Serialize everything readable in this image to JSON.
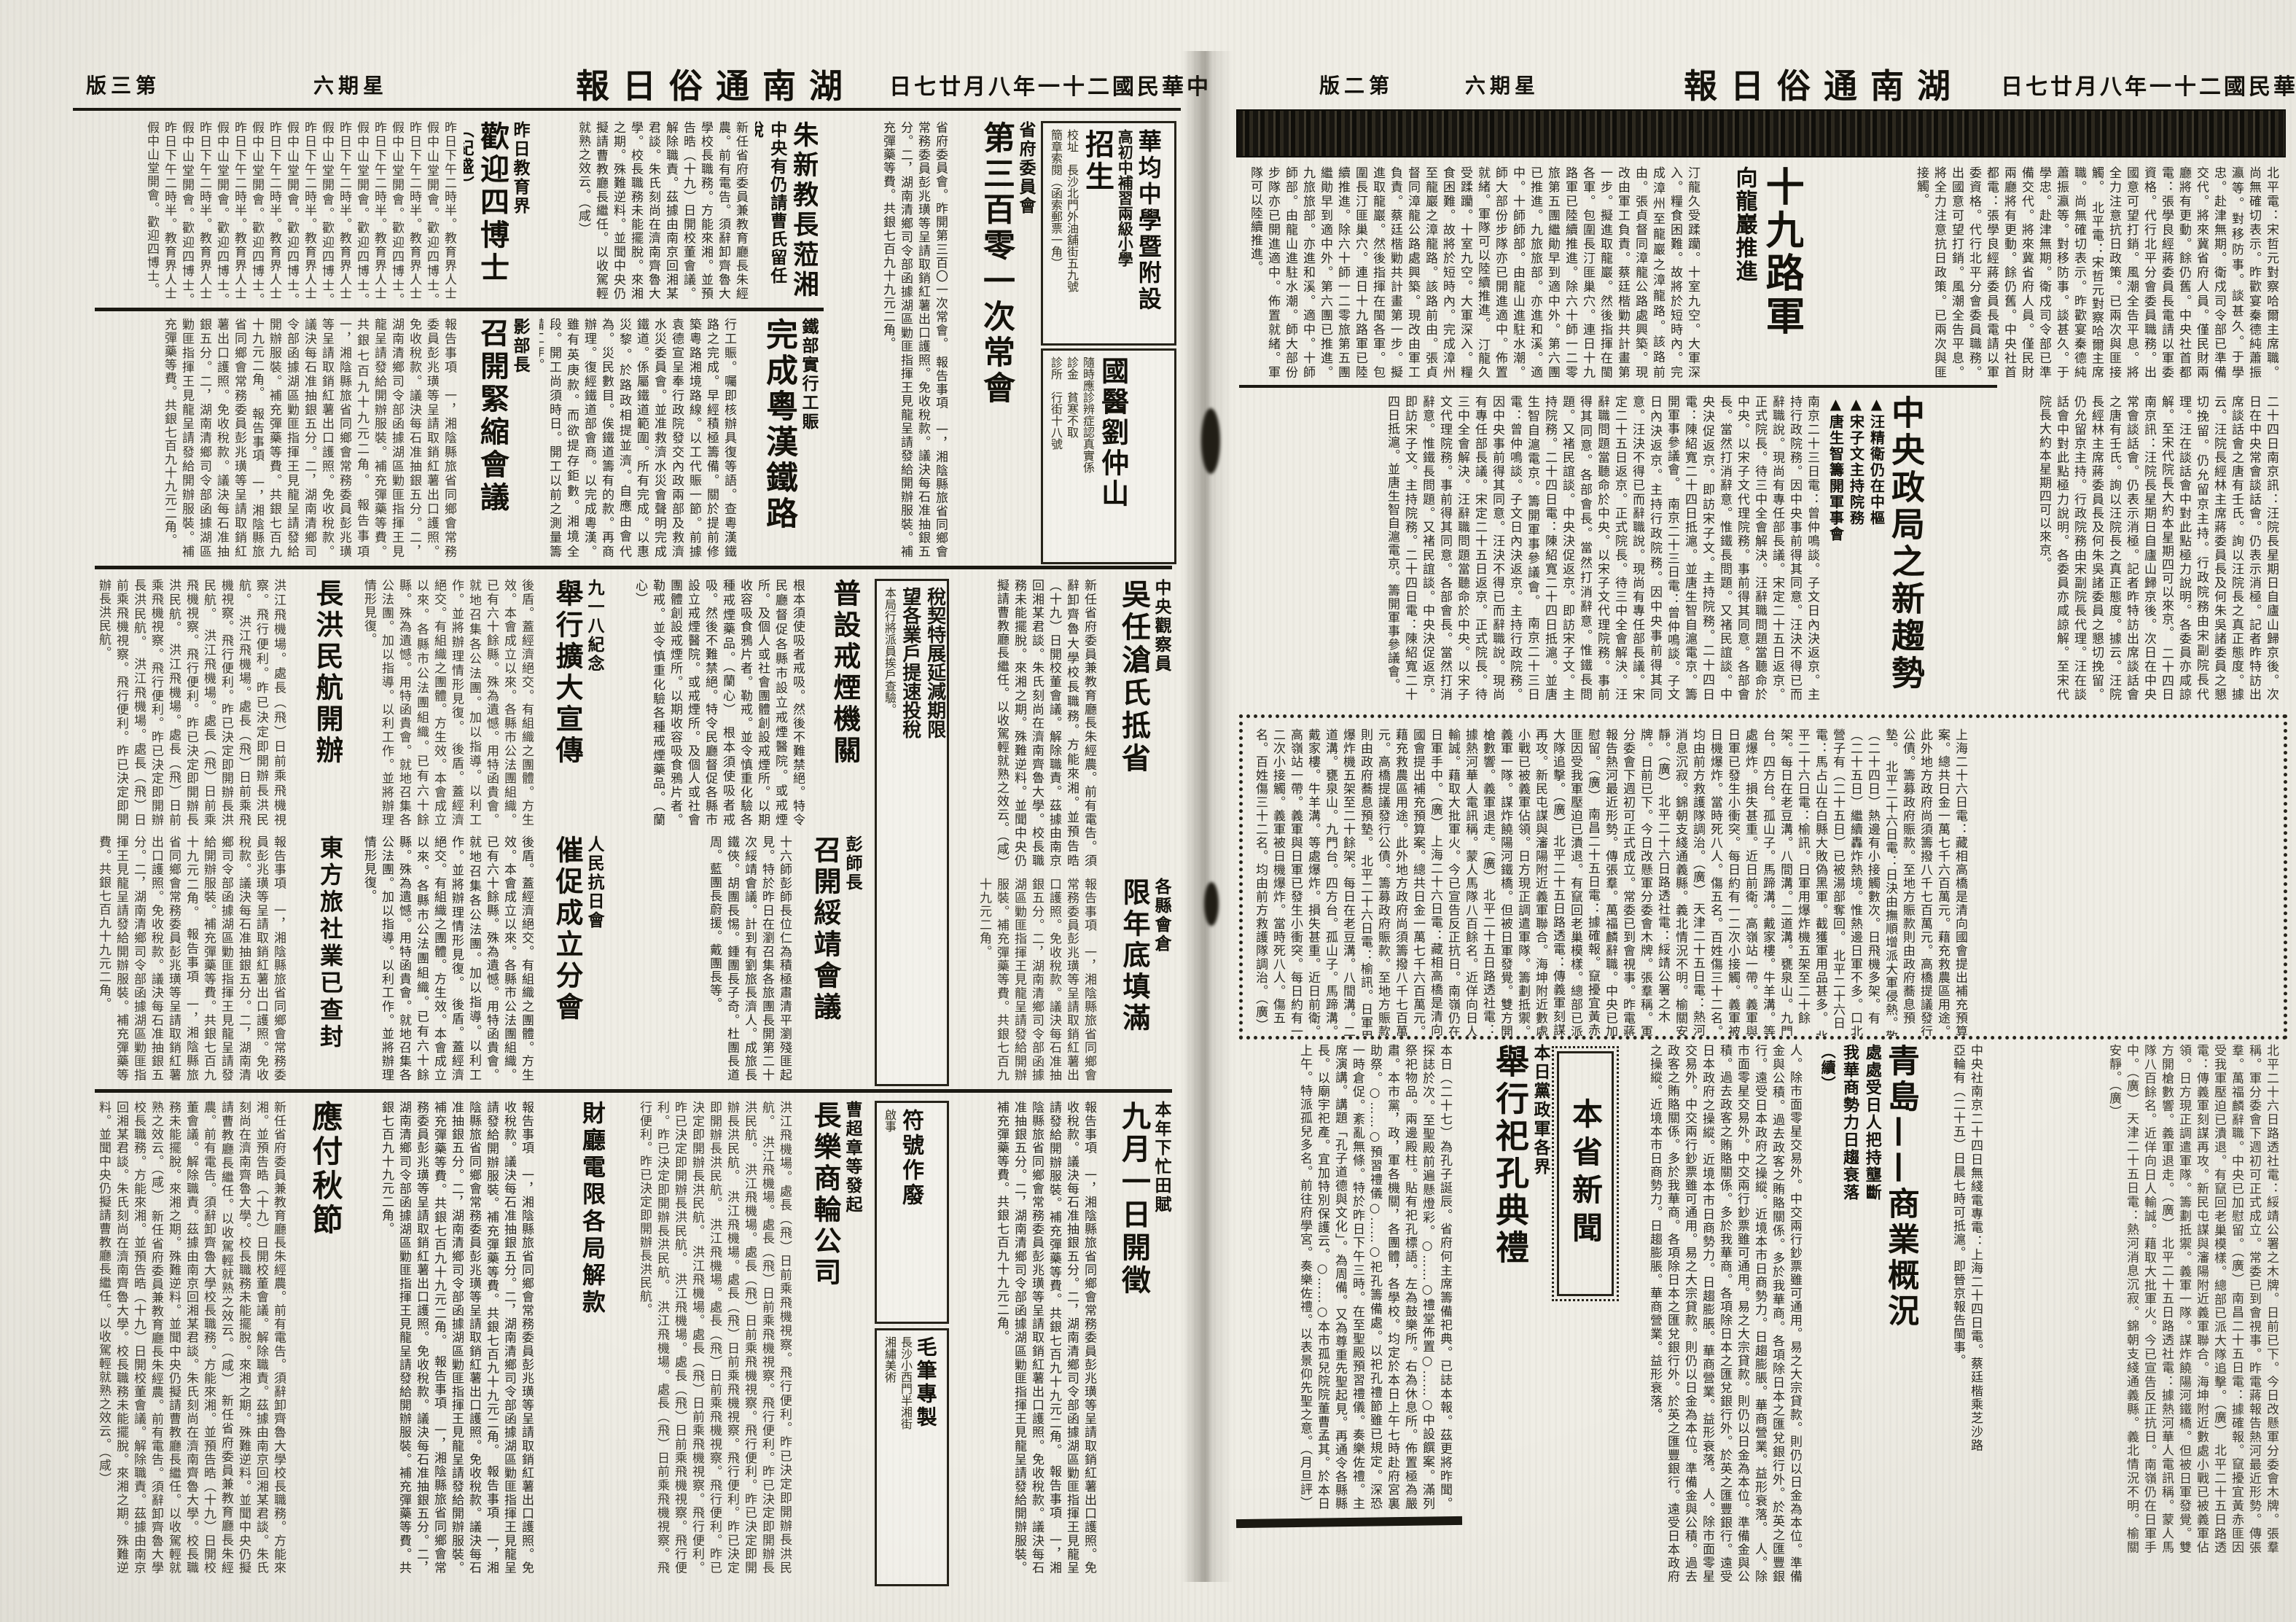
{
  "paper": {
    "name": "湖南通俗日報",
    "date": "中華民國二十一年八月廿七日",
    "weekday": "星期六"
  },
  "page_left": {
    "edition": "第三版",
    "ads": {
      "school": {
        "title": "華均中學暨附設",
        "line2": "高初中補習兩級小學",
        "enroll": "招生",
        "addr": "校址　長沙北門外油舖街五九號",
        "note": "簡章索閱（函索郵票一角）"
      },
      "doctor": {
        "title": "國醫劉仲山",
        "line1": "隨時應診辨症認真實係",
        "line2": "診金　貧寒不取",
        "line3": "診所　行街十八號"
      },
      "tax": {
        "org": "長沙省會稅務徵收局通告",
        "big1": "稅契特展延減期限",
        "big2": "望各業戶提速投稅",
        "note": "本局行將派員挨戶查驗。"
      },
      "fuhao": {
        "title": "符號作廢",
        "note": "啟事"
      },
      "brush": {
        "title": "毛筆專製",
        "line1": "長沙小西門半湘街",
        "line2": "湘繡美術"
      }
    },
    "articles": {
      "provincial": {
        "kicker": "省府委員會",
        "headline": "第三百零一次常會",
        "lead": "省府委員會。昨開第三百〇一次常會。",
        "body": "報告事項　一，湘陰縣旅省同鄉會常務委員彭兆璜等呈請取銷紅薯出口護照。免收稅款。議決每石准抽銀五分。二，湖南清鄉司令部函據湖區勦匪指揮王見龍呈請發給開辦服裝。補充彈藥等費。共銀七百九十九元二角。"
      },
      "zhu": {
        "headline": "朱新教長蒞湘",
        "sub": "中央有仍請曹氏留任說",
        "body": "新任省府委員兼教育廳長朱經農。前有電告。須辭卸齊魯大學校長職務。方能來湘。並預告晧（十九）日開校董會議。解除職責。茲據由南京回湘某君談。朱氏刻尚在濟南齊魯大學。校長職務未能擺脫。來湘之期。殊難逆料。並聞中央仍擬請曹教廳長繼任。以收駕輕就熟之效云。（咸）"
      },
      "welcome": {
        "kicker": "昨日教育界",
        "headline": "歡迎四博士",
        "sub": "（紀盛）",
        "body": "昨日下午二時半。教育界人士假中山堂開會。歡迎四博士。"
      },
      "railway": {
        "kicker": "鐵部實行工賑",
        "headline": "完成粵漢鐵路",
        "body": "行工賑。囑即核辦具復等語。查粵漢鐵路之完成。早經積極籌備。關於提前修築粵路湘境路線。以工代賑一節。前據袁德宣呈奉行政院發交內政兩部及救濟水災委員會。並准救濟水災會聲明完成鐵道。係屬鐵道範圍。所有完成。以惠災黎。於路政相提並濟。自應由會代為。災民數目。俟鐵道籌有的款。再商辦理。復經鐵道部會商。以完成粵漢。雖有英庚款。而欲提存鉅數。湘境全段。開工尚須時日。開工以前之測量籌備工作。"
      },
      "jinsuo": {
        "kicker": "影部長",
        "headline": "召開緊縮會議"
      },
      "wu": {
        "kicker": "中央觀察員",
        "headline": "吳任滄氏抵省"
      },
      "granary": {
        "kicker": "各縣會倉",
        "headline": "限年底填滿"
      },
      "opium": {
        "headline": "普設戒煙機關",
        "body": "根本須使吸者戒吸。然後不難禁絕。特令民廳督促各縣市設立戒煙醫院。或戒煙所。及個人或社會團體創設戒煙所。以期收容吸食鴉片者。勒戒。並令慎重化驗各種戒煙藥品。（蘭心）"
      },
      "peng": {
        "kicker": "彭師長",
        "headline": "召開綏靖會議",
        "body": "十六師彭師長位仁為積極肅清平瀏殘匪起見。特於昨日在瀏召集各旅團長開第二十次綏靖會議。計到有劉旅長濟人。成旅長鐵俠。胡團長惕。鍾團長子奇。杜團長道周。藍團長蔚援。戴團長等。"
      },
      "sep18": {
        "kicker": "九一八紀念",
        "headline": "舉行擴大宣傳"
      },
      "cuicu": {
        "kicker": "人民抗日會",
        "headline": "催促成立分會",
        "body": "後盾。蓋經濟絕交。有組織之團體。方生效。本會成立以來。各縣市公法團組織。已有六十餘縣。殊為遺憾。用特函貴會。就地召集各公法團。加以指導。以利工作。並將辦理情形見復。"
      },
      "changhong": {
        "headline": "長洪民航開辦",
        "body": "洪江飛機場。處長（飛）日前乘飛機視察。飛行便利。昨已決定即開辦長洪民航。"
      },
      "eastern": {
        "headline": "東方旅社業已查封"
      },
      "tian": {
        "kicker": "本年下忙田賦",
        "headline": "九月一日開徵"
      },
      "caoting": {
        "kicker": "曹超章等發起",
        "headline": "長樂商輪公司"
      },
      "treasury": {
        "headline": "財廳電限各局解款"
      },
      "autumn": {
        "headline": "應付秋節"
      }
    }
  },
  "page_right": {
    "edition": "第二版",
    "route19": {
      "headline": "十九路軍",
      "sub": "向龍巖推進",
      "body_a": "北平電：宋哲元對察哈爾主席職。尚無確切表示。昨歡宴秦德純蕭振瀛等。對移防事。談甚久。于學忠。赴津無期。衛戍司令部已準備交代。將來冀省府人員。僅民財兩廳將有更動。餘仍舊。中央社首都電：張學良經蔣委員長電請以軍委資格。代行北平分會委員職務。出國意可望打銷。風潮全告平息。將全力注意抗日政策。已兩次與匪接觸。",
      "body_b": "汀龍久受蹂躪。十室九空。大軍深入。糧食困難。故將於短時內。完成漳州至龍巖之漳龍路。該路前由。張貞督同漳龍公路處興築。現改由軍工負責。蔡廷楷勦共計畫第一步。擬進取龍巖。然後指揮在閩各軍。包圍長汀匪巢穴。連日十九路軍已陸續推進。除六十師一二零旅第五團繼勛早到適中外。第六團已推進。九旅旅部。亦進和溪。適中。十師師部。由龍山進駐水潮。師大部份步隊亦已開進適中。佈置就緒。軍隊可以陸續推進。"
    },
    "central": {
      "headline": "中央政局之新趨勢",
      "bullet1": "▲汪精衛仍在中樞",
      "bullet2": "▲宋子文主持院務",
      "bullet3": "▲唐生智籌開軍事會",
      "bullet4": "▲李濟琛辭職與蔡廷楷入京",
      "body_a": "二十四日南京訊：汪院長星期日自廬山歸京後。次日在中央常會談話會。仍表示消極。記者昨特訪出席談話會之唐有壬氏。詢以汪院長之真正態度。據云。汪院長經林主席蔣委員長及何朱吳諸委員之懇切挽留。仍允留京主持。行政院務由宋副院長代理。汪在談話會中對此點極力說明。各委員亦咸諒解。至宋代院長大約本星期四可以來京。",
      "body_b": "南京二十三日電：曾仲鳴談。子文日內決返京。主持行政院務。因中央事前得其同意。汪決不得已而辭職說。現尚有專任部長議。宋定二十五日返京。正式院長。待三中全會解決。汪辭職問題當聽命於中央。以宋子文代理院務。事前得其同意。各部會長。當然打消辭意。惟鐵長問題。又褚民誼談。中央決促返京。即訪宋子文。主持院務。二十四日電：陳紹寬二十四日抵滬。並唐生智自滬電京。籌開軍事參議會。"
    },
    "briefs": [
      "上海二十六日電：藏相高橋是清向國會提出補充預算案。總共日金一萬七千六百萬元。藉充救農區用途。此外地方政府尚須籌撥八千七百萬元。高橋提議發行公債。籌募政府賑款。至地方賑款則由政府蕎息預墊。",
      "北平二十六日電：日決由撫順增派大軍侵熱。敬（二十四日）熱邊有小接觸數次。日飛機多架。有（二十五日）繼續轟炸熱境。惟熱邊日軍不多。口北營子有（二十五日）已被湯部奪回。",
      "北平二十六日電：馬占山在白縣大敗偽黑軍。截獲軍用品甚多。",
      "北平二十六日電：榆訊。日軍用爆炸機五架至二十餘架。每日在老豆溝。八間溝。二道溝。甕泉山。九門台。四方台。孤山子。馬蹄溝。戴家樓。牛羊溝。等處爆炸。損失甚重。近日前衛。高嶺站一帶。義軍與日軍已發生小衝突。每日約有一二次小接觸。義軍被日機爆炸。當時死八人。傷五名。百姓傷三十二名。均由前方救護隊調治。（廣）",
      "天津二十五日電：熱河消息沉寂。錦朝支綫通義縣。義北情況不明。榆關安靜。（廣）",
      "北平二十六日路透社電：綏靖公署之木牌。日前已下。今日改懸軍分委會木牌。張羣稱。軍分委會下週初可正式成立。常委已到會視事。昨電蔣報告熱河最近形勢。傳張羣。萬福麟辭職。中央已加慰留。（廣）",
      "南昌二十五日電：據確報。竄擾宜黃赤匪因受我軍壓迫已潰退。有竄回老巢模樣。總部已派大隊追擊。（廣）",
      "北平二十五日路透電：傳義軍刻謀再攻。新民屯謀與瀋陽附近義軍聯合。海坤附近數處小戰已被義軍佔領。日方現正調遣軍隊。籌劃抵禦。義軍一隊。謀炸饒陽河鐵橋。但被日軍發覺。雙方開槍數響。義軍退走。（廣）",
      "北平二十五日路透社電：據熱河華人電訊稱。蒙人馬隊八百餘名。近佯向日人輸誠。藉取大批軍火。今已宣告反正抗日。南嶺仍在日軍手中。（廣）"
    ],
    "qingdao": {
      "headline": "青島——商業概況",
      "sub1": "處處受日人把持壟斷",
      "sub2": "我華商勢力日趨衰落",
      "sub3": "（續）",
      "wire": "中央社南京二十四日無綫電專電：上海二十四日電。蔡廷楷乘芝沙路亞輪有（二十五）日晨七時可抵滬。即晉京報告閩事。",
      "body": "人。除市面零星交易外。中交兩行鈔票雖可通用。易之大宗貸款。則仍以日金為本位。準備金與公積。過去政客之賄賂關係。多於我華商。各項除日本之匯兌銀行外。於英之匯豐銀行。遠受日本政府之操縱。近境本市日商勢力。日趨膨脹。華商營業。益形衰落。"
    },
    "local_news": {
      "section": "本省新聞"
    },
    "sacrifice": {
      "kicker": "本日黨政軍各界",
      "headline": "舉行祀孔典禮",
      "body": "本日（二十七）為孔子誕辰。省府何主席籌備祀典。已誌本報。茲更將昨聞。探誌於次。至聖殿前遍懸燈彩。○……○禮堂佈置○……○中設饌案。滿列祭祀物品。兩邊殿柱。貼有祀孔標語。左為鼓樂所。右為休息所。佈置極為嚴肅。本市黨，政，軍各機關，各團體，各學校。均定於本日上午七時赴府宮裏助祭。○……○預習禮儀○……○祀孔籌備處。以祀孔禮節雖已規定。深恐一時倉促。紊亂無條。特於昨日下午三時。在至聖殿預習禮儀。奏樂佐禮。主席演講。講題「孔子道德與文化」。為周備。又為尊重先聖起見。再通令各縣縣長。以廟宇祀產。宜加特別保護云。○……○本市孤兒院院董曹孟其。於本日上午。特派孤兒多名。前往府學宮。奏樂佐禮。以表景仰先聖之意。（月旦評）"
    }
  }
}
